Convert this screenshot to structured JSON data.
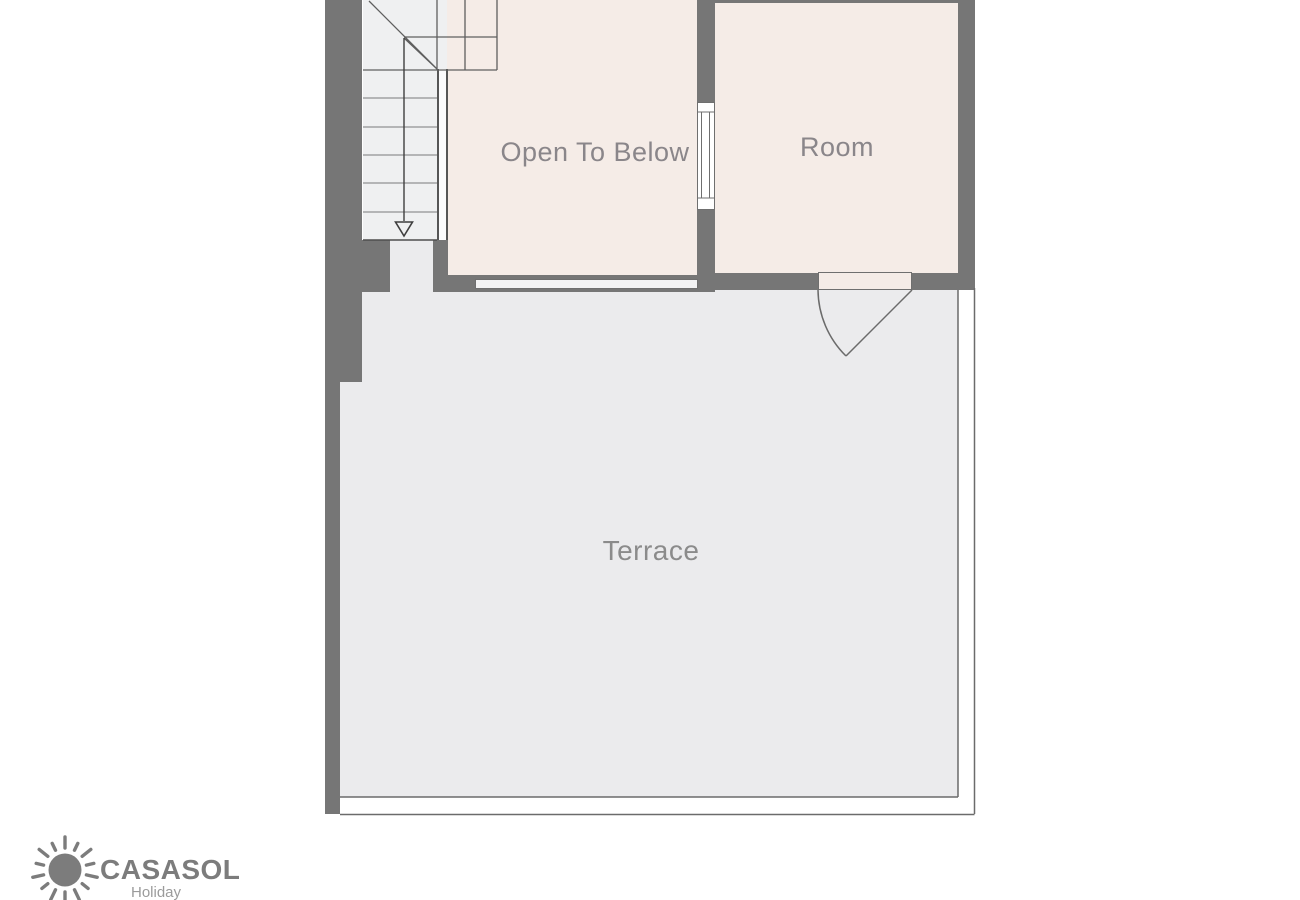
{
  "plan": {
    "rooms": [
      {
        "id": "open-to-below",
        "label": "Open To Below"
      },
      {
        "id": "room",
        "label": "Room"
      },
      {
        "id": "terrace",
        "label": "Terrace"
      }
    ],
    "features": {
      "stairs_direction_icon": "down-arrow-icon",
      "door": "door-swing-arc",
      "interior_window": "window-symbol",
      "glazed_band": "window-band"
    },
    "colors": {
      "wall": "#767676",
      "room_fill": "#f5ece7",
      "terrace_fill": "#ebebed",
      "stairs_fill": "#eff0f1",
      "line": "#606060",
      "label_text": "#8a868a"
    }
  },
  "logo": {
    "brand": "CASASOL",
    "tagline": "Holiday",
    "icon": "sun-icon",
    "color": "#7c7c7c"
  }
}
